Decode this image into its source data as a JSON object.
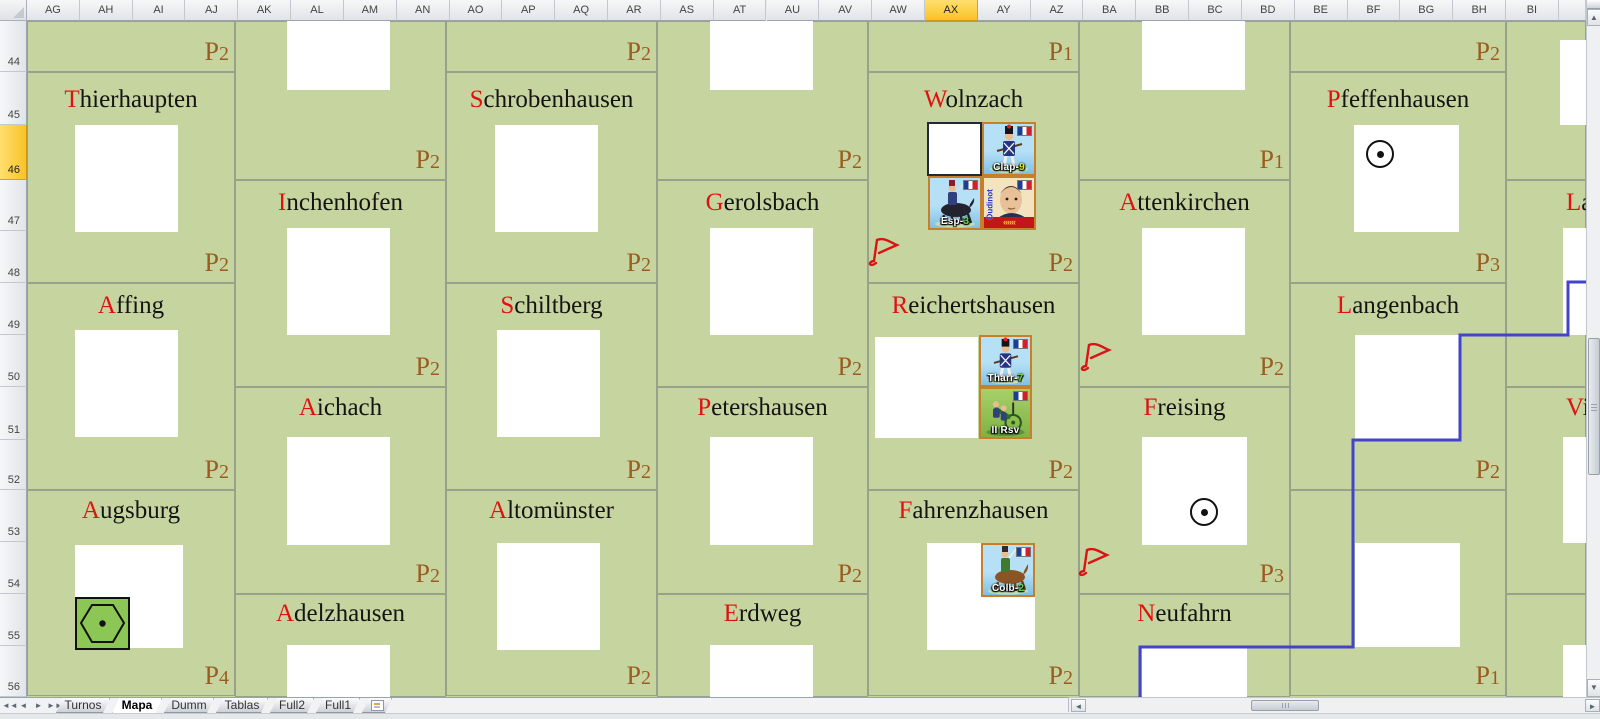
{
  "spreadsheet": {
    "column_headers": [
      "AG",
      "AH",
      "AI",
      "AJ",
      "AK",
      "AL",
      "AM",
      "AN",
      "AO",
      "AP",
      "AQ",
      "AR",
      "AS",
      "AT",
      "AU",
      "AV",
      "AW",
      "AX",
      "AY",
      "AZ",
      "BA",
      "BB",
      "BC",
      "BD",
      "BE",
      "BF",
      "BG",
      "BH",
      "BI"
    ],
    "selected_column": "AX",
    "row_headers": [
      "44",
      "45",
      "46",
      "47",
      "48",
      "49",
      "50",
      "51",
      "52",
      "53",
      "54",
      "55",
      "56"
    ],
    "selected_row": "46",
    "row_bounds": [
      [
        21,
        72
      ],
      [
        72,
        125
      ],
      [
        125,
        180
      ],
      [
        180,
        231
      ],
      [
        231,
        283
      ],
      [
        283,
        335
      ],
      [
        335,
        387
      ],
      [
        387,
        440
      ],
      [
        440,
        490
      ],
      [
        490,
        542
      ],
      [
        542,
        594
      ],
      [
        594,
        646
      ],
      [
        646,
        697
      ]
    ]
  },
  "map": {
    "background_color": "#c6d5a0",
    "region_border_color": "#9aa18b",
    "boundary_color": "#4343cb",
    "p_label_color": "#9b5c1f",
    "name_initial_color": "#e01111",
    "regions": [
      {
        "name": "",
        "p": "P2",
        "x": 27,
        "y": 21,
        "w": 208,
        "h": 51
      },
      {
        "name": "Thierhaupten",
        "p": "P2",
        "x": 27,
        "y": 72,
        "w": 208,
        "h": 211,
        "name_y": 86
      },
      {
        "name": "Affing",
        "p": "P2",
        "x": 27,
        "y": 283,
        "w": 208,
        "h": 207,
        "name_y": 292
      },
      {
        "name": "Augsburg",
        "p": "P4",
        "x": 27,
        "y": 490,
        "w": 208,
        "h": 206,
        "name_y": 497
      },
      {
        "name": "",
        "p": "P2",
        "x": 235,
        "y": 21,
        "w": 211,
        "h": 159
      },
      {
        "name": "Inchenhofen",
        "p": "P2",
        "x": 235,
        "y": 180,
        "w": 211,
        "h": 207,
        "name_y": 189
      },
      {
        "name": "Aichach",
        "p": "P2",
        "x": 235,
        "y": 387,
        "w": 211,
        "h": 207,
        "name_y": 394
      },
      {
        "name": "Adelzhausen",
        "p": "",
        "x": 235,
        "y": 594,
        "w": 211,
        "h": 103,
        "name_y": 600
      },
      {
        "name": "",
        "p": "P2",
        "x": 446,
        "y": 21,
        "w": 211,
        "h": 51
      },
      {
        "name": "Schrobenhausen",
        "p": "P2",
        "x": 446,
        "y": 72,
        "w": 211,
        "h": 211,
        "name_y": 86
      },
      {
        "name": "Schiltberg",
        "p": "P2",
        "x": 446,
        "y": 283,
        "w": 211,
        "h": 207,
        "name_y": 292
      },
      {
        "name": "Altomünster",
        "p": "P2",
        "x": 446,
        "y": 490,
        "w": 211,
        "h": 206,
        "name_y": 497
      },
      {
        "name": "",
        "p": "P2",
        "x": 657,
        "y": 21,
        "w": 211,
        "h": 159
      },
      {
        "name": "Gerolsbach",
        "p": "P2",
        "x": 657,
        "y": 180,
        "w": 211,
        "h": 207,
        "name_y": 189
      },
      {
        "name": "Petershausen",
        "p": "P2",
        "x": 657,
        "y": 387,
        "w": 211,
        "h": 207,
        "name_y": 394
      },
      {
        "name": "Erdweg",
        "p": "",
        "x": 657,
        "y": 594,
        "w": 211,
        "h": 103,
        "name_y": 600
      },
      {
        "name": "",
        "p": "P1",
        "x": 868,
        "y": 21,
        "w": 211,
        "h": 51
      },
      {
        "name": "Wolnzach",
        "p": "P2",
        "x": 868,
        "y": 72,
        "w": 211,
        "h": 211,
        "name_y": 86
      },
      {
        "name": "Reichertshausen",
        "p": "P2",
        "x": 868,
        "y": 283,
        "w": 211,
        "h": 207,
        "name_y": 292
      },
      {
        "name": "Fahrenzhausen",
        "p": "P2",
        "x": 868,
        "y": 490,
        "w": 211,
        "h": 206,
        "name_y": 497
      },
      {
        "name": "",
        "p": "P1",
        "x": 1079,
        "y": 21,
        "w": 211,
        "h": 159
      },
      {
        "name": "Attenkirchen",
        "p": "P2",
        "x": 1079,
        "y": 180,
        "w": 211,
        "h": 207,
        "name_y": 189
      },
      {
        "name": "Freising",
        "p": "P3",
        "x": 1079,
        "y": 387,
        "w": 211,
        "h": 207,
        "name_y": 394
      },
      {
        "name": "Neufahrn",
        "p": "",
        "x": 1079,
        "y": 594,
        "w": 211,
        "h": 103,
        "name_y": 600
      },
      {
        "name": "",
        "p": "P2",
        "x": 1290,
        "y": 21,
        "w": 216,
        "h": 51
      },
      {
        "name": "Pfeffenhausen",
        "p": "P3",
        "x": 1290,
        "y": 72,
        "w": 216,
        "h": 211,
        "name_y": 86
      },
      {
        "name": "Langenbach",
        "p": "P2",
        "x": 1290,
        "y": 283,
        "w": 216,
        "h": 207,
        "name_y": 292
      },
      {
        "name": "",
        "p": "P1",
        "x": 1290,
        "y": 490,
        "w": 216,
        "h": 206
      },
      {
        "name": "",
        "p": "",
        "x": 1506,
        "y": 21,
        "w": 80,
        "h": 159
      },
      {
        "name": "La",
        "cut": true,
        "name_x": 1566,
        "p": "",
        "x": 1506,
        "y": 180,
        "w": 80,
        "h": 207,
        "name_y": 189
      },
      {
        "name": "Vi",
        "cut": true,
        "name_x": 1566,
        "p": "",
        "x": 1506,
        "y": 387,
        "w": 80,
        "h": 207,
        "name_y": 394
      },
      {
        "name": "",
        "p": "",
        "x": 1506,
        "y": 594,
        "w": 80,
        "h": 103
      }
    ],
    "town_boxes": [
      [
        75,
        125,
        103,
        107
      ],
      [
        75,
        330,
        103,
        107
      ],
      [
        75,
        545,
        108,
        103
      ],
      [
        287,
        21,
        103,
        69
      ],
      [
        287,
        228,
        103,
        107
      ],
      [
        287,
        437,
        103,
        108
      ],
      [
        287,
        645,
        103,
        52
      ],
      [
        495,
        125,
        103,
        107
      ],
      [
        497,
        330,
        103,
        107
      ],
      [
        497,
        543,
        103,
        107
      ],
      [
        710,
        21,
        103,
        69
      ],
      [
        710,
        228,
        103,
        107
      ],
      [
        710,
        437,
        103,
        108
      ],
      [
        710,
        645,
        103,
        52
      ],
      [
        875,
        337,
        103,
        101
      ],
      [
        927,
        543,
        108,
        107
      ],
      [
        1142,
        21,
        103,
        69
      ],
      [
        1142,
        228,
        103,
        107
      ],
      [
        1142,
        437,
        105,
        108
      ],
      [
        1142,
        648,
        105,
        49
      ],
      [
        1354,
        125,
        105,
        107
      ],
      [
        1355,
        335,
        105,
        105
      ],
      [
        1355,
        543,
        105,
        104
      ],
      [
        1560,
        40,
        26,
        85
      ],
      [
        1563,
        228,
        23,
        107
      ],
      [
        1563,
        437,
        23,
        106
      ],
      [
        1563,
        645,
        23,
        52
      ]
    ],
    "selected_cell": {
      "ref": "AX46",
      "x": 927,
      "y": 122,
      "w": 55,
      "h": 54
    },
    "counters": [
      {
        "id": "clap-9",
        "label": "Clap-",
        "num": "9",
        "num_color": "#d8e83a",
        "type": "infantry",
        "bg": "bgblue",
        "x": 982,
        "y": 122,
        "w": 54,
        "h": 54
      },
      {
        "id": "esp-3",
        "label": "Esp-",
        "num": "3",
        "num_color": "#5cd83a",
        "type": "cavalry_dark",
        "bg": "bgblue",
        "x": 928,
        "y": 176,
        "w": 54,
        "h": 54
      },
      {
        "id": "oudinot",
        "label": "Oudinot",
        "num": "",
        "num_color": "",
        "type": "leader",
        "bg": "bgcream",
        "x": 982,
        "y": 176,
        "w": 54,
        "h": 54
      },
      {
        "id": "tharr-7",
        "label": "Tharr-",
        "num": "7",
        "num_color": "#5cd83a",
        "type": "infantry",
        "bg": "bgblue",
        "x": 979,
        "y": 335,
        "w": 53,
        "h": 52
      },
      {
        "id": "ii-rsv",
        "label": "II Rsv",
        "num": "",
        "num_color": "",
        "type": "artillery",
        "bg": "bggreen",
        "x": 979,
        "y": 387,
        "w": 53,
        "h": 52
      },
      {
        "id": "colb-2",
        "label": "Colb-",
        "num": "2",
        "num_color": "#5cd83a",
        "type": "cavalry_brown",
        "bg": "bgblue",
        "x": 981,
        "y": 543,
        "w": 54,
        "h": 54
      }
    ],
    "circle_markers": [
      {
        "x": 1366,
        "y": 140,
        "d": 28
      },
      {
        "x": 1190,
        "y": 498,
        "d": 28
      }
    ],
    "hex_marker": {
      "x": 75,
      "y": 597,
      "w": 55,
      "h": 53
    },
    "red_flags": [
      {
        "x": 866,
        "y": 233
      },
      {
        "x": 1078,
        "y": 338
      },
      {
        "x": 1076,
        "y": 543
      }
    ],
    "boundary_points": [
      [
        1600,
        282
      ],
      [
        1568,
        282
      ],
      [
        1568,
        335
      ],
      [
        1460,
        335
      ],
      [
        1460,
        440
      ],
      [
        1353,
        440
      ],
      [
        1353,
        647
      ],
      [
        1140,
        647
      ],
      [
        1140,
        697
      ]
    ]
  },
  "tabs": {
    "nav": [
      "first",
      "previous",
      "next",
      "last"
    ],
    "items": [
      {
        "label": "Turnos",
        "active": false
      },
      {
        "label": "Mapa",
        "active": true
      },
      {
        "label": "Dumm",
        "active": false
      },
      {
        "label": "Tablas",
        "active": false
      },
      {
        "label": "Full2",
        "active": false
      },
      {
        "label": "Full1",
        "active": false
      }
    ]
  },
  "scrollbars": {
    "vertical_thumb": {
      "top": 338,
      "bottom": 475
    },
    "horizontal_thumb": {
      "left": 1250,
      "right": 1318
    }
  }
}
